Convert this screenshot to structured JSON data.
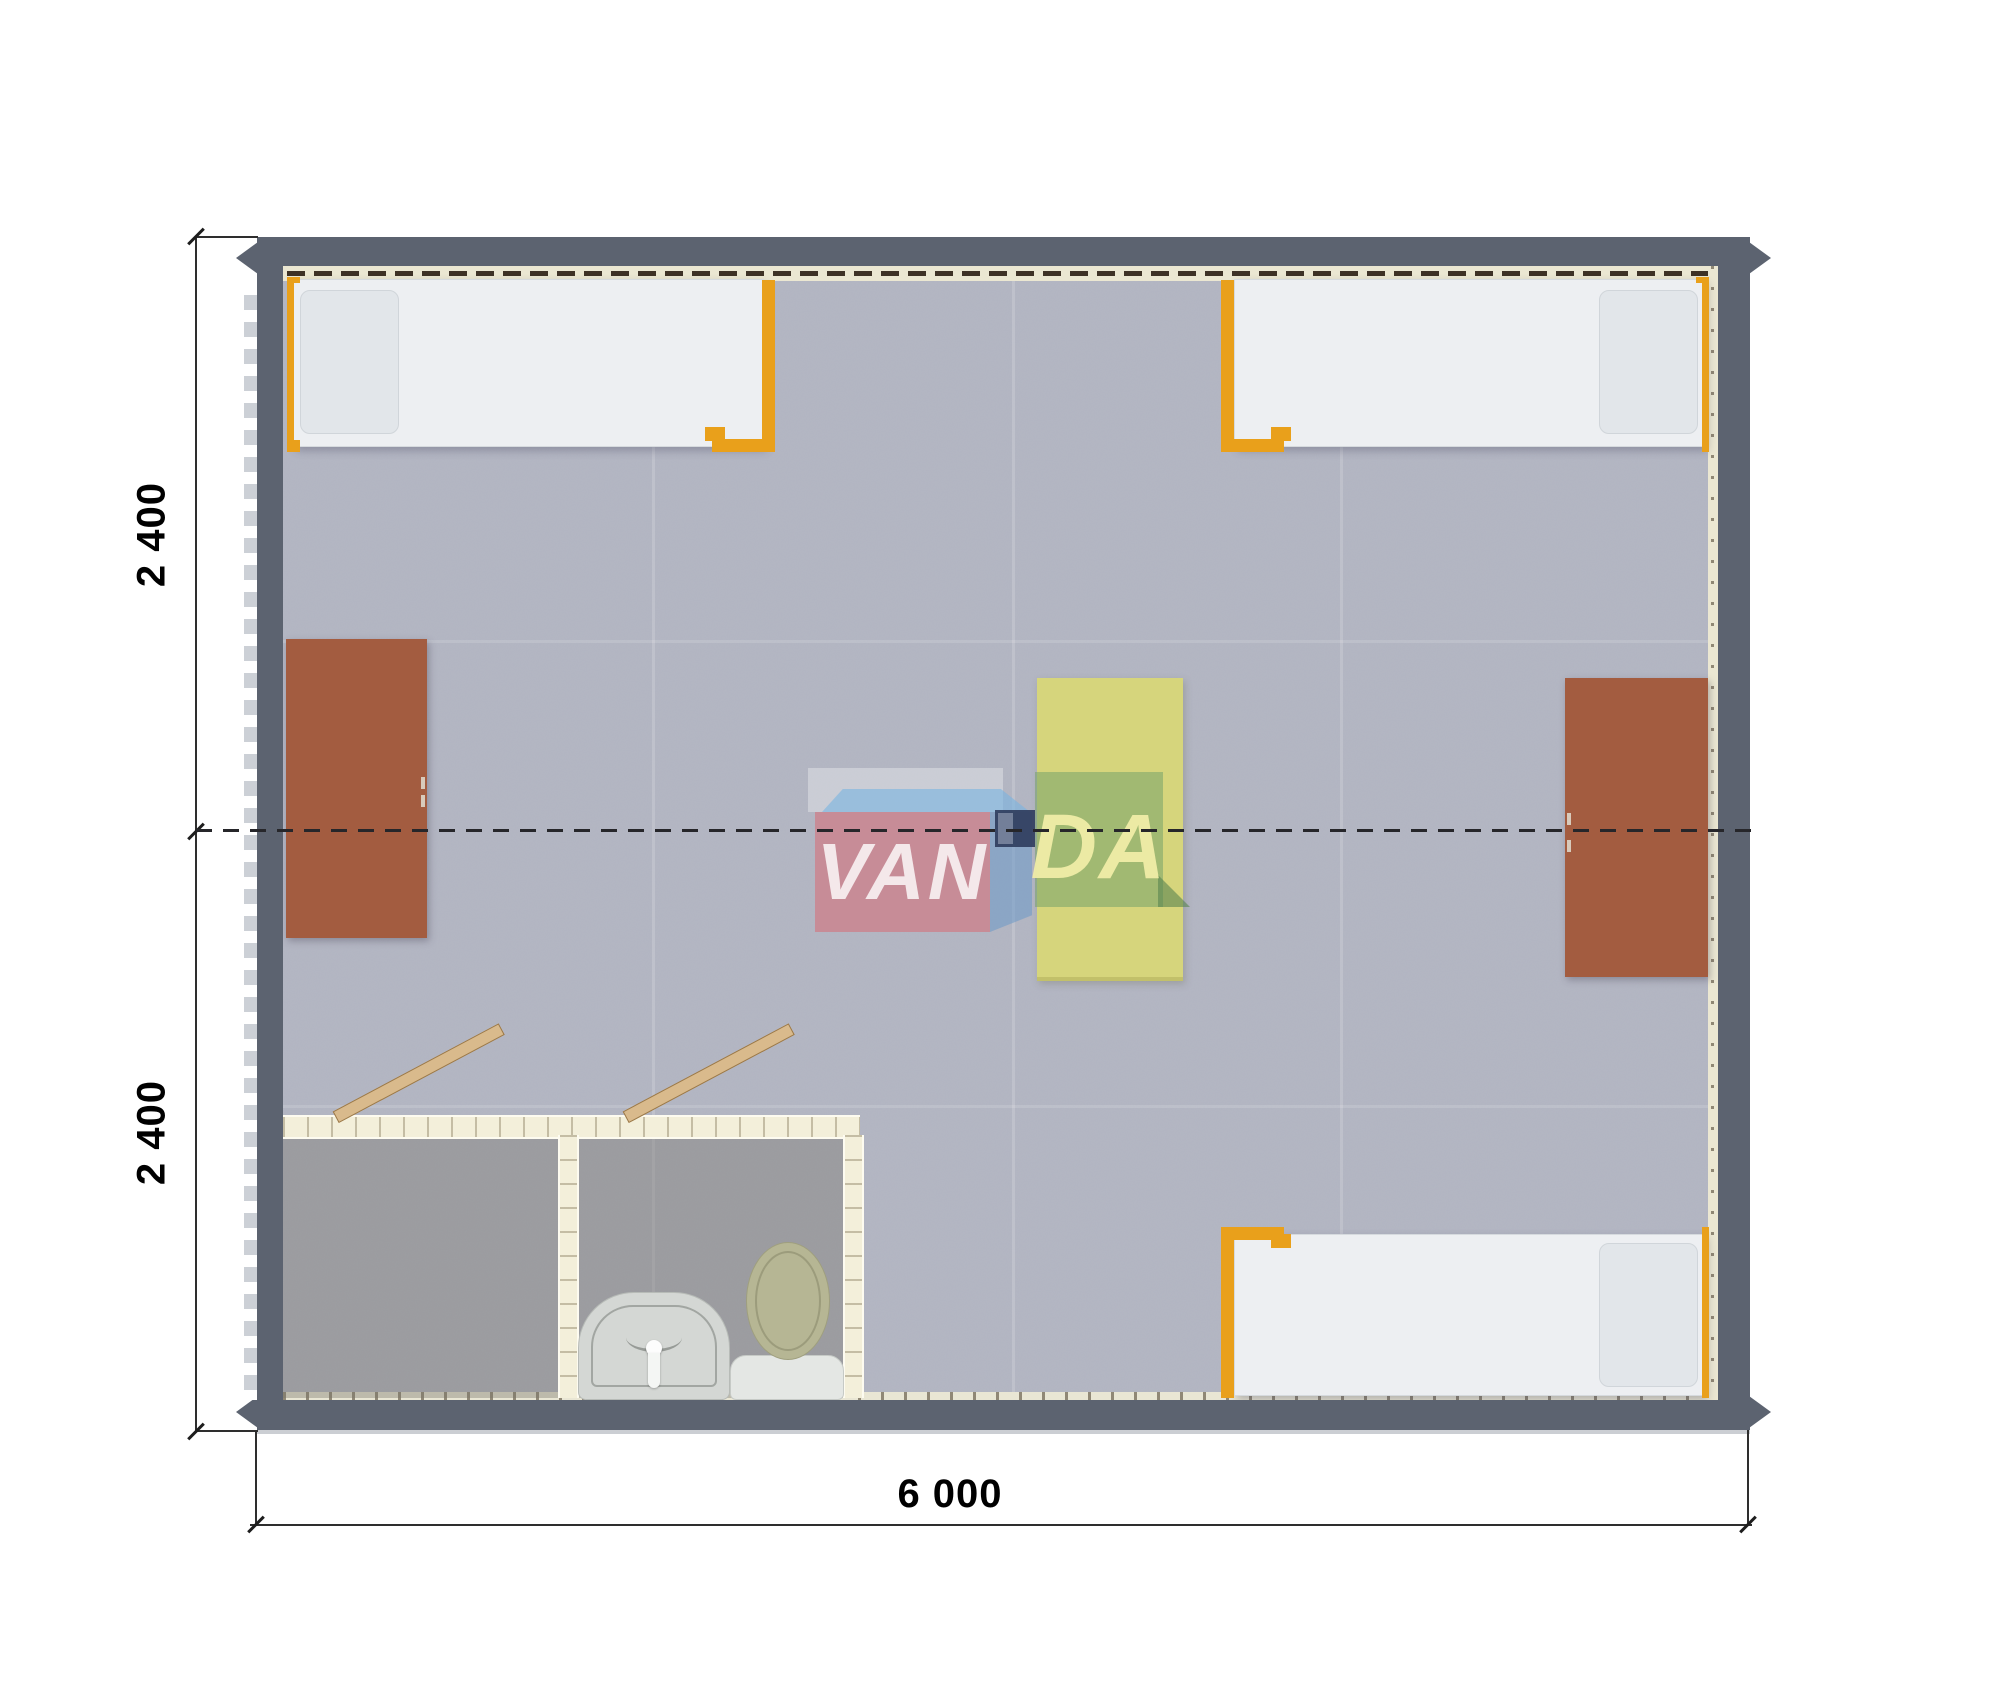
{
  "drawing": {
    "type": "modular-building floor plan render, top view",
    "dimension_labels": {
      "left_top": "2 400",
      "left_bottom": "2 400",
      "bottom": "6 000"
    },
    "watermark": {
      "left": "VAN",
      "right": "DA"
    },
    "colors": {
      "wall": "#5c6370",
      "carpet": "#b4b7c4",
      "bed_frame_orange": "#e9a01b",
      "mattress": "#edeff2",
      "desk_brown": "#a35c40",
      "table_yellow": "#d6d57c",
      "partition_cream": "#f3efda",
      "door_wood": "#d9ba8c",
      "logo_red": "#d27680",
      "logo_blue": "#78b4e1",
      "logo_navy": "#303e5e",
      "logo_green": "#76a26a"
    },
    "furniture_counts": {
      "beds": 3,
      "desks": 2,
      "center_table": 1,
      "toilet": 1,
      "sink": 1,
      "open_doors": 2
    }
  }
}
